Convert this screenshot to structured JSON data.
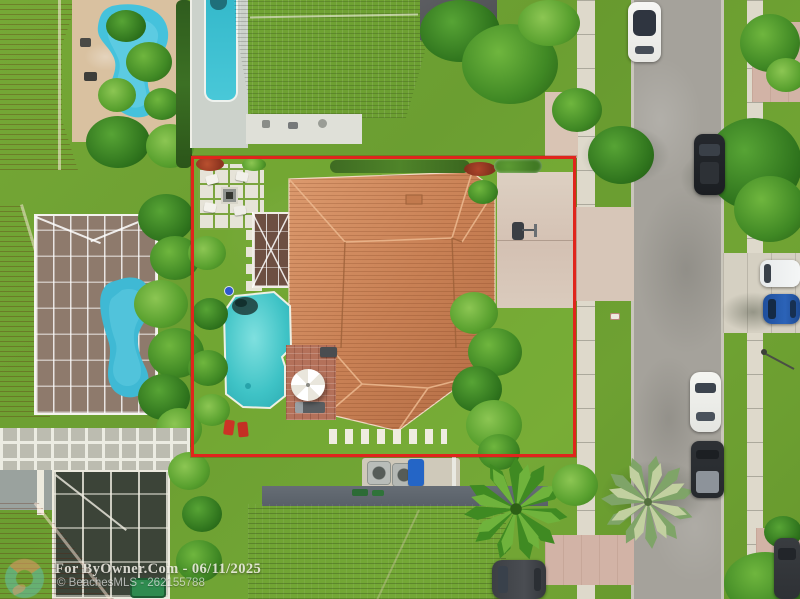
{
  "image": {
    "type": "aerial-real-estate-photo",
    "description": "Overhead drone view of a single-family home with tile roof, screened lanai, backyard pool and driveway; property lot outlined in red; residential street with parked cars on the right; neighboring homes with pools around.",
    "width": 800,
    "height": 599
  },
  "watermark": {
    "line1": "For ByOwner.Com - 06/11/2025",
    "line2": "© BeachesMLS - 262155788",
    "brand": "ByOwner.Com",
    "date": "06/11/2025",
    "mls_source": "BeachesMLS",
    "listing_id": "262155788",
    "logo": "byowner-swirl-logo"
  },
  "colors": {
    "boundary_red": "#e0251c",
    "main_roof_terracotta": "#c98155",
    "neighbor_roof_orange": "#bd4b27",
    "pool_teal": "#3fc3c6",
    "neighbor_pool_blue": "#45c2dc",
    "grass_green": "#6fa234",
    "street_gray": "#a5a29b",
    "sidewalk_tan": "#ded9cb",
    "shingle_brown": "#7d6a54"
  },
  "scene_features": {
    "main_property": [
      "red-lot-outline",
      "terracotta-hip-roof-house",
      "swimming-pool",
      "screened-lanai",
      "fire-pit-patio",
      "paver-path",
      "brick-patio-with-umbrella",
      "driveway",
      "basketball-hoop",
      "stepping-stones",
      "tropical-landscaping"
    ],
    "street": [
      "sidewalks",
      "grass-verges",
      "parked-cars"
    ],
    "parked_vehicles": [
      "white-car",
      "dark-suv",
      "white-minivan",
      "blue-car",
      "white-sedan",
      "dark-pickup",
      "dark-car",
      "driveway-suv"
    ]
  }
}
